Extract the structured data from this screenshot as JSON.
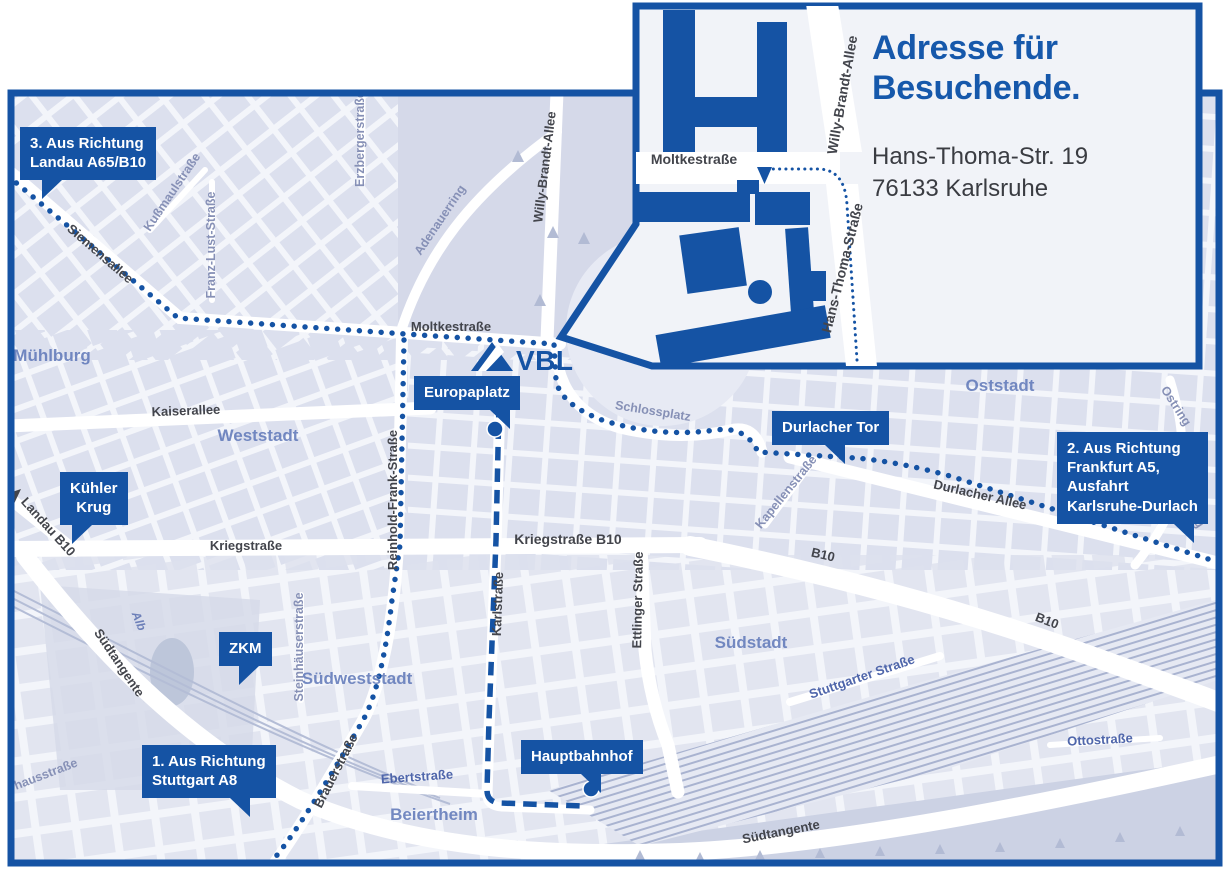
{
  "colors": {
    "brand_blue": "#1553a4",
    "title_blue": "#1658ab",
    "map_background": "#f3f5fa",
    "block_fill": "#dce0ee",
    "park_fill": "#d3d8e8",
    "railway_line": "#a9b3d0",
    "street_label_dark": "#43454c",
    "street_label_minor": "#8690b6",
    "street_label_blue": "#4f66ab",
    "district_label": "#5e77b8"
  },
  "logo": {
    "text": "VBL"
  },
  "inset": {
    "title": "Adresse für\nBesuchende.",
    "address": "Hans-Thoma-Str. 19\n76133 Karlsruhe",
    "streets": {
      "moltkestrasse": "Moltkestraße",
      "willy_brandt_allee": "Willy-Brandt-Allee",
      "hans_thoma_strasse": "Hans-Thoma-Straße"
    }
  },
  "badges": {
    "landau": "3. Aus Richtung\nLandau A65/B10",
    "kuehler_krug": "Kühler\nKrug",
    "zkm": "ZKM",
    "stuttgart": "1. Aus Richtung\nStuttgart A8",
    "europaplatz": "Europaplatz",
    "durlacher_tor": "Durlacher Tor",
    "frankfurt": "2. Aus Richtung\nFrankfurt A5,\nAusfahrt\nKarlsruhe-Durlach",
    "hauptbahnhof": "Hauptbahnhof"
  },
  "streets": {
    "siemensallee": "Siemensallee",
    "moltkestrasse": "Moltkestraße",
    "kaiserallee": "Kaiserallee",
    "kriegstrasse": "Kriegstraße",
    "kriegstrasse_b10": "Kriegstraße B10",
    "durlacher_allee": "Durlacher Allee",
    "b10_a": "B10",
    "b10_b": "B10",
    "landau_b10": "Landau B10",
    "suedtangente_west": "Südtangente",
    "suedtangente_sued": "Südtangente",
    "brauerstrasse": "Brauerstraße",
    "willy_brandt_allee": "Willy-Brandt-Allee",
    "reinhold_frank_strasse": "Reinhold-Frank-Straße",
    "karlstrasse": "Karlstraße",
    "ettlinger_strasse": "Ettlinger Straße",
    "kapellenstrasse": "Kapellenstraße",
    "ostring_a": "Ostring",
    "ostring_b": "Ostring",
    "erzbergerstrasse": "Erzbergerstraße",
    "franz_lust_strasse": "Franz-Lust-Straße",
    "kussmaulstrasse": "Kußmaulstraße",
    "adenauerring": "Adenauerring",
    "steinhaeuserstrasse": "Steinhäuserstraße",
    "schlossplatz": "Schlossplatz",
    "ebertstrasse": "Ebertstraße",
    "stuttgarter_strasse": "Stuttgarter Straße",
    "ottostrasse": "Ottostraße",
    "alb": "Alb",
    "pulverhausstrasse": "Pulverhausstraße"
  },
  "districts": {
    "muehlburg": "Mühlburg",
    "weststadt": "Weststadt",
    "oststadt": "Oststadt",
    "suedstadt": "Südstadt",
    "suedweststadt": "Südweststadt",
    "beiertheim": "Beiertheim"
  }
}
